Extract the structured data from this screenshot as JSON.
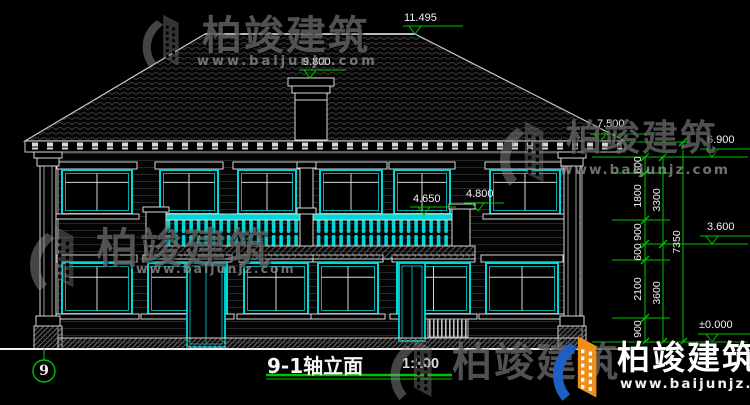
{
  "title": {
    "name": "9-1轴立面",
    "scale": "1:100"
  },
  "axis": {
    "label": "9"
  },
  "elevations": {
    "ridge": "11.495",
    "chimney": "9.800",
    "eave": "7.500",
    "second_top": "6.900",
    "balcony_rail": "4.650",
    "balcony_pier": "4.800",
    "second_floor": "3.600",
    "ground": "±0.000"
  },
  "dims": {
    "inner": [
      "600",
      "1800",
      "900",
      "600",
      "2100",
      "900"
    ],
    "mid": [
      "3300",
      "3600"
    ],
    "outer": [
      "7350"
    ]
  },
  "watermark": {
    "brand": "柏竣建筑",
    "url": "www.baijunjz.com"
  },
  "colors": {
    "background": "#000000",
    "drawing_line": "#d8d8d8",
    "window_cyan": "#00d8d8",
    "dimension_green": "#00c300",
    "watermark_gray": "#949494",
    "logo_blue": "#1e5fc4",
    "logo_orange": "#ee8f1a"
  }
}
